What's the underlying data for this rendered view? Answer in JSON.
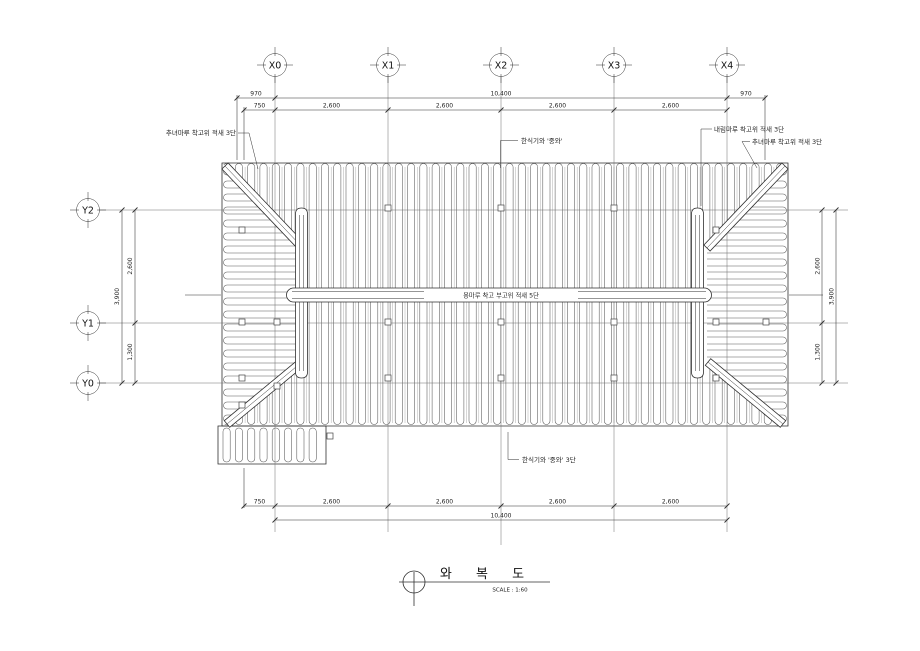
{
  "meta": {
    "drawing_type": "korean-traditional-roof-tile-plan",
    "background": "#ffffff",
    "line_color": "#2f2f2f"
  },
  "grid": {
    "x_bubbles": [
      {
        "label": "X0"
      },
      {
        "label": "X1"
      },
      {
        "label": "X2"
      },
      {
        "label": "X3"
      },
      {
        "label": "X4"
      }
    ],
    "y_bubbles": [
      {
        "label": "Y2"
      },
      {
        "label": "Y1"
      },
      {
        "label": "Y0"
      }
    ]
  },
  "dimensions": {
    "top": {
      "overall_left": "970",
      "overall_center": "10,400",
      "overall_right": "970",
      "eave_left": "750",
      "bays": [
        "2,600",
        "2,600",
        "2,600",
        "2,600"
      ]
    },
    "bottom": {
      "eave_left": "750",
      "bays": [
        "2,600",
        "2,600",
        "2,600",
        "2,600"
      ],
      "overall": "10,400"
    },
    "left": {
      "overall": "3,900",
      "upper": "2,600",
      "lower": "1,300"
    },
    "right": {
      "overall": "3,900",
      "upper": "2,600",
      "lower": "1,300"
    }
  },
  "annotations": {
    "top_left_hip": "추녀마루 착고위 적새 3단",
    "top_right_descending": "내림마루 착고위 적새 3단",
    "top_right_hip": "추녀마루 착고위 적새 3단",
    "tile_note_top": "한식기와 '중와'",
    "tile_note_bottom": "한식기와 '중와' 3단",
    "main_ridge": "용마루 착고 부고위 적새 5단"
  },
  "title_block": {
    "title": "와 복 도",
    "scale": "SCALE : 1:60"
  }
}
